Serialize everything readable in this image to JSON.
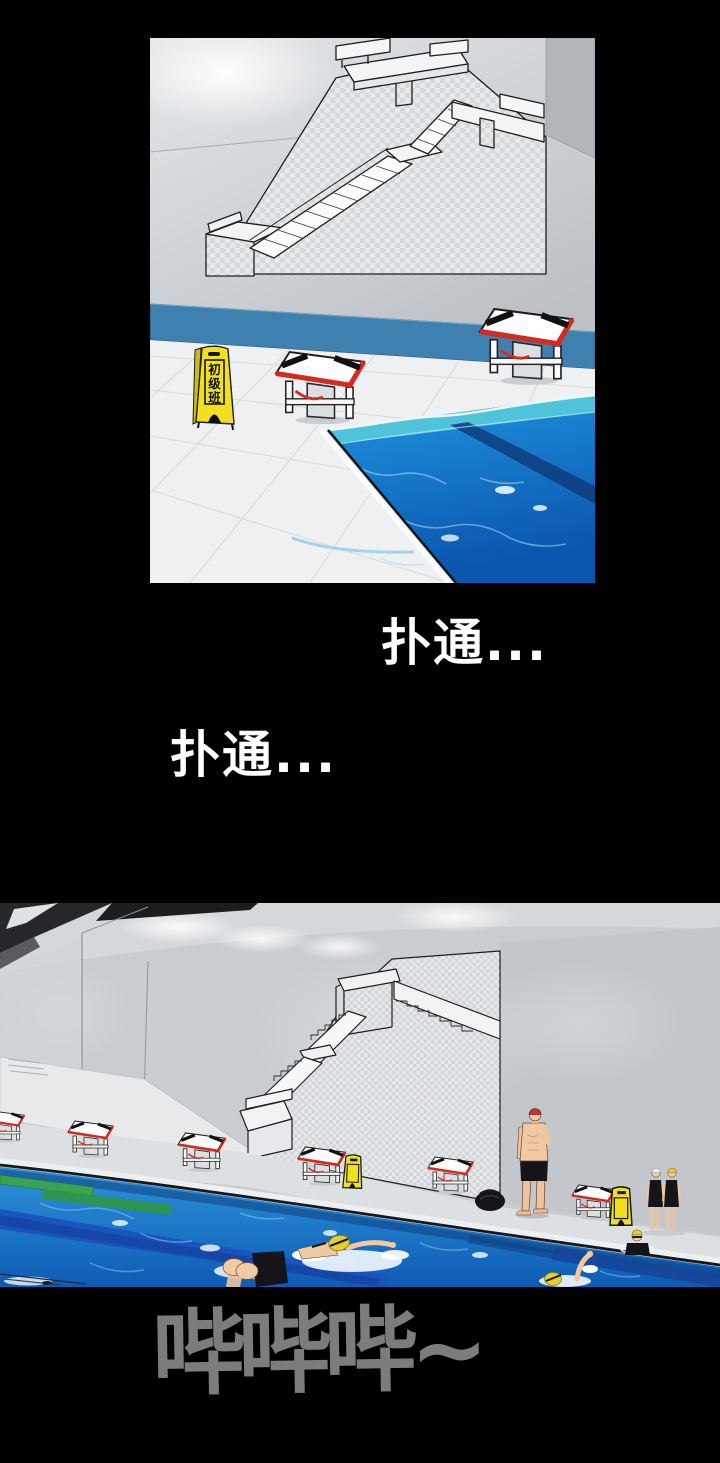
{
  "sfx": {
    "splash_right": "扑通...",
    "splash_left": "扑通...",
    "whistle": "哔哔哔~"
  },
  "panel_top": {
    "sign": {
      "label": "初级班",
      "char1": "初",
      "char2": "级",
      "char3": "班"
    }
  },
  "colors": {
    "page_bg": "#000000",
    "sfx_white": "#ffffff",
    "sfx_gray": "#7c7c7c",
    "caution_yellow": "#f2df1d",
    "pool_band_blue": "#3e80b0",
    "block_red": "#d22b20",
    "cap_red": "#c43430",
    "cap_yellow": "#e6cf2d",
    "water_blue": "#1e7fd0",
    "water_teal": "#4fc3da",
    "lane_navy": "#1b52bd",
    "lane_green": "#3aa44d"
  }
}
